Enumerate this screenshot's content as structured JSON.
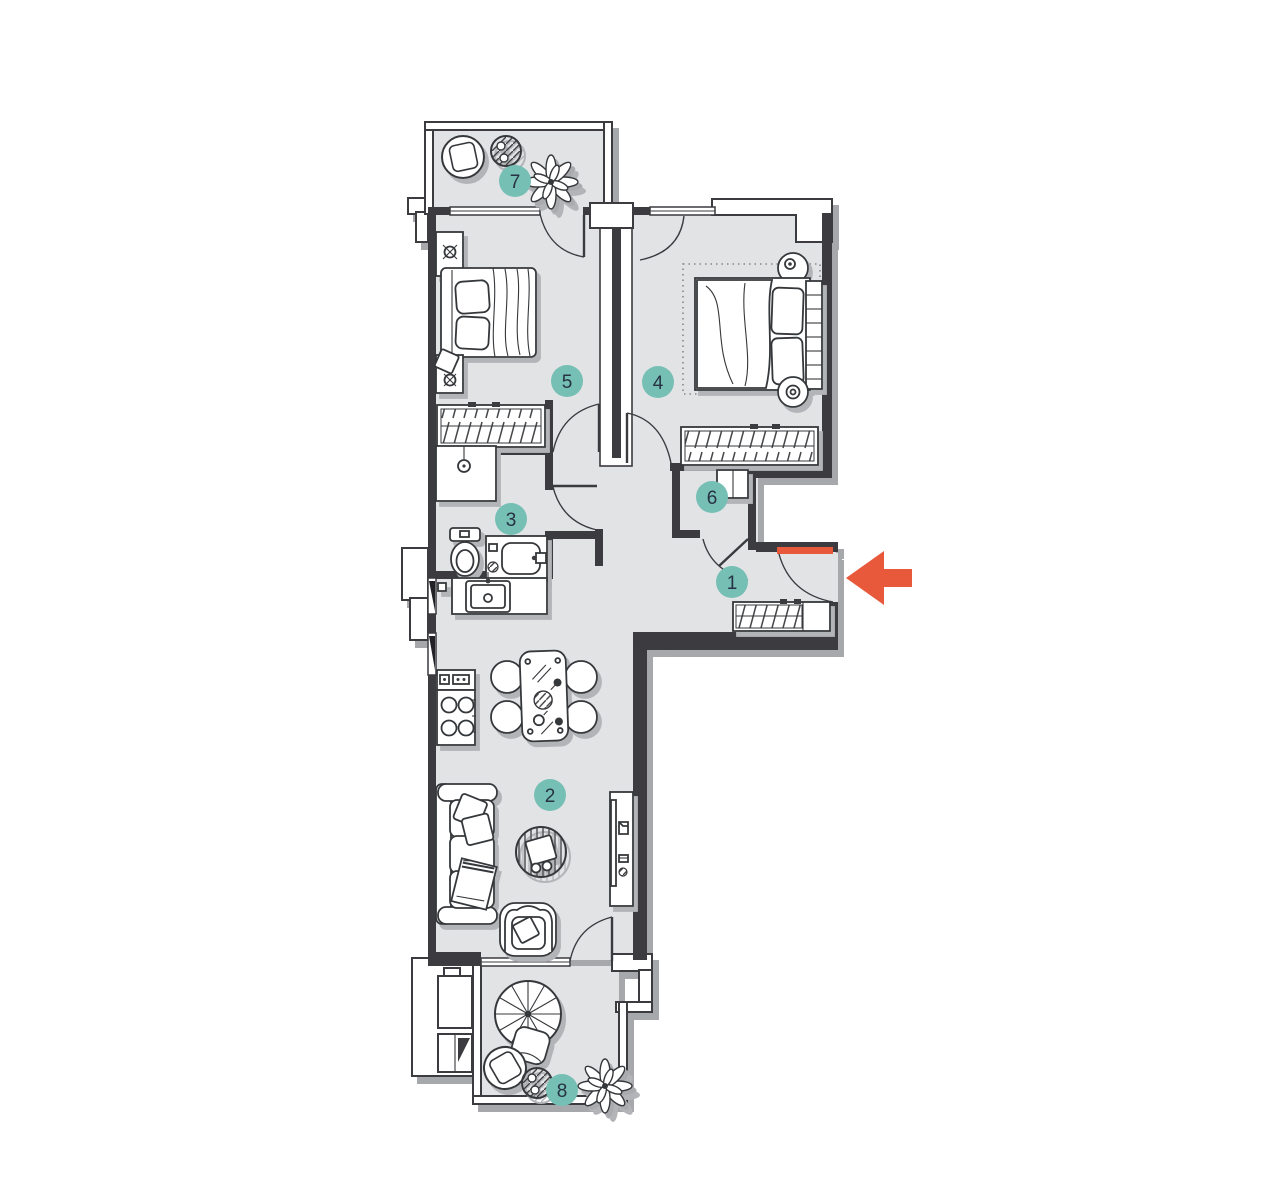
{
  "page": {
    "background": "#ffffff",
    "content": "apartment floor plan"
  },
  "colors": {
    "floor": "#e2e3e5",
    "walls": "#3a3b3f",
    "furniture_outline": "#36373b",
    "marker_fill": "#76bfb5",
    "marker_text": "#273243",
    "entrance_accent": "#e8593c",
    "shadow": "#a6a8ab"
  },
  "rooms": [
    {
      "label": "1",
      "name": "hallway"
    },
    {
      "label": "2",
      "name": "living-room-with-kitchen"
    },
    {
      "label": "3",
      "name": "bathroom"
    },
    {
      "label": "4",
      "name": "bedroom"
    },
    {
      "label": "5",
      "name": "bedroom"
    },
    {
      "label": "6",
      "name": "storage-closet"
    },
    {
      "label": "7",
      "name": "balcony"
    },
    {
      "label": "8",
      "name": "terrace"
    }
  ],
  "entrance": {
    "icon": "left-arrow",
    "door_highlight": "#e8593c"
  },
  "icons": {
    "furniture": [
      "double-bed",
      "wardrobe",
      "nightstand",
      "shower",
      "toilet",
      "vanity-sink",
      "kitchen-sink",
      "stove",
      "dining-table",
      "dining-chair",
      "sofa",
      "coffee-table",
      "armchair",
      "tv-stand",
      "lounge-chair",
      "side-table",
      "parasol-table",
      "plant"
    ]
  }
}
